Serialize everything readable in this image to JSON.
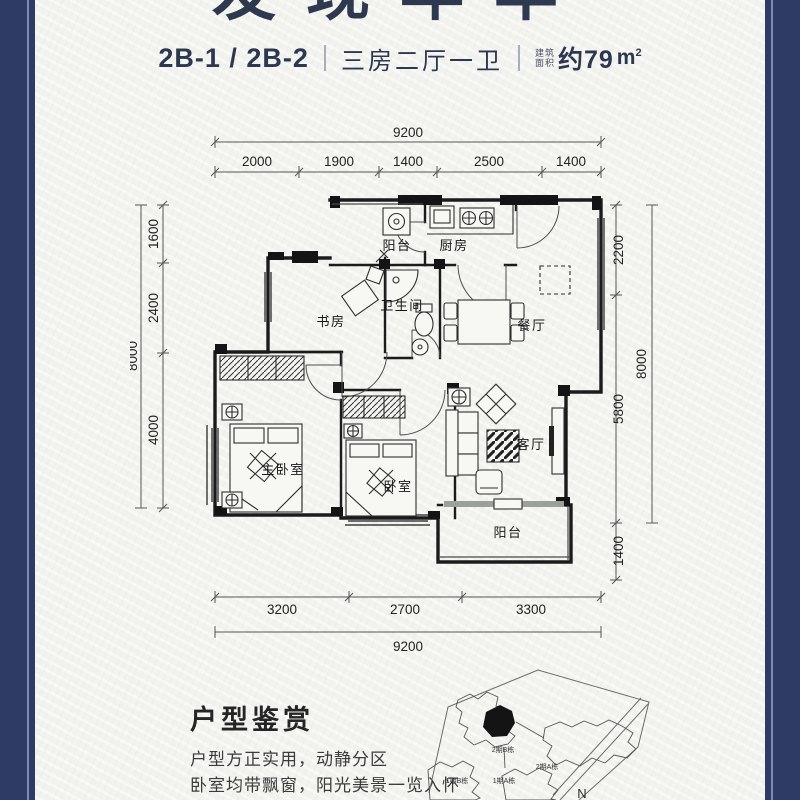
{
  "header": {
    "project_title_partial": "发现年华",
    "unit_code": "2B-1 / 2B-2",
    "layout_desc": "三房二厅一卫",
    "area_label_top": "建筑",
    "area_label_bottom": "面积",
    "area_value": "约79",
    "area_unit_letter": "m",
    "area_unit_sup": "2"
  },
  "floorplan": {
    "room_labels": {
      "balcony_top": "阳台",
      "kitchen": "厨房",
      "study": "书房",
      "bathroom": "卫生间",
      "dining": "餐厅",
      "master_bedroom": "主卧室",
      "bedroom": "卧室",
      "living": "客厅",
      "balcony_bottom": "阳台"
    },
    "dimensions": {
      "top_total": "9200",
      "top_segments": [
        "2000",
        "1900",
        "1400",
        "2500",
        "1400"
      ],
      "bottom_segments": [
        "3200",
        "2700",
        "3300"
      ],
      "bottom_total": "9200",
      "left_segments": [
        "1600",
        "2400",
        "4000"
      ],
      "left_total": "8000",
      "right_segments": [
        "2200",
        "5800",
        "1400"
      ],
      "right_total": "8000"
    }
  },
  "appreciation": {
    "heading": "户型鉴赏",
    "line1": "户型方正实用，动静分区",
    "line2": "卧室均带飘窗，阳光美景一览入怀",
    "line3": "双卧朝南，清风徐来"
  },
  "site_map": {
    "building_b2": "2期B栋",
    "building_a2": "2期A栋",
    "building_b1": "1期B栋",
    "building_a1": "1期A栋",
    "north_label": "N"
  },
  "colors": {
    "border_navy": "#2e3c63",
    "accent_line": "#7b8db5",
    "paper": "#f2f3ee",
    "title_ink": "#2e3950",
    "plan_line": "#1b1b1b"
  }
}
